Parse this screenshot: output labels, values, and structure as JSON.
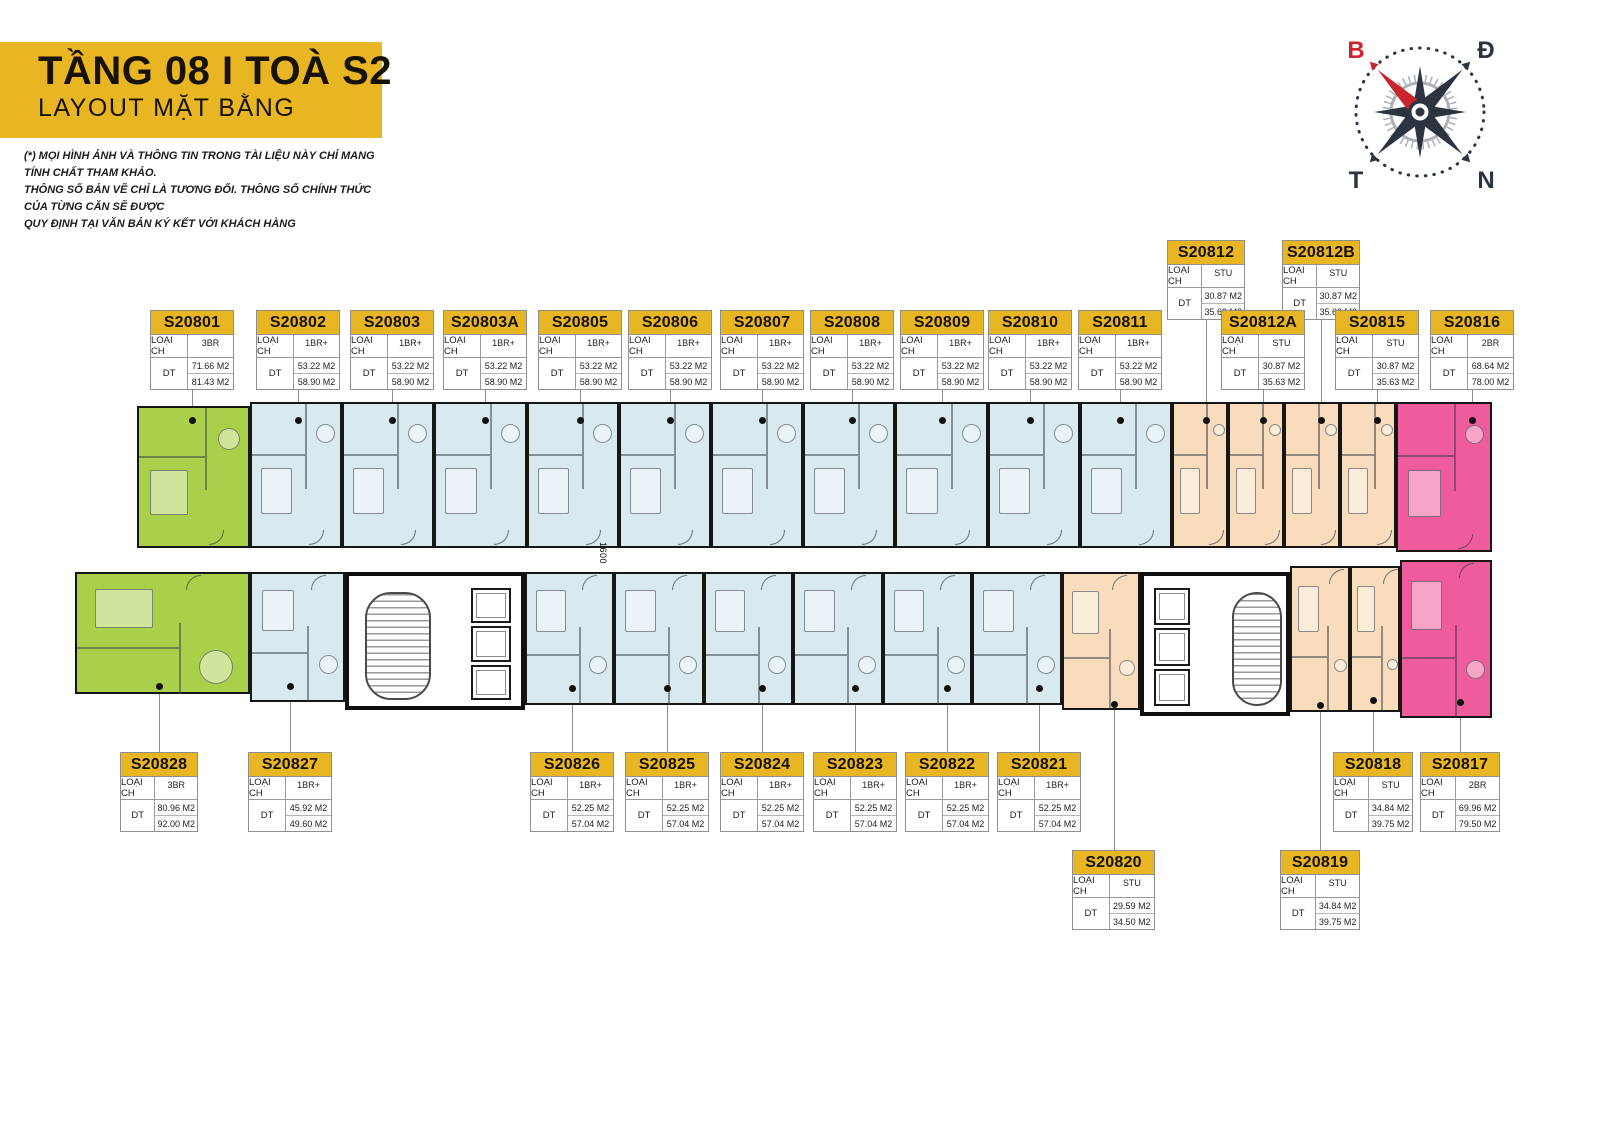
{
  "header": {
    "title": "TẦNG 08 I TOÀ S2",
    "subtitle": "LAYOUT MẶT BẰNG",
    "disclaimer": [
      "(*) MỌI HÌNH ẢNH VÀ THÔNG TIN TRONG TÀI LIỆU NÀY CHỈ MANG TÍNH CHẤT THAM KHẢO.",
      "THÔNG SỐ BẢN VẼ CHỈ LÀ TƯƠNG ĐỐI. THÔNG SỐ CHÍNH THỨC CỦA TỪNG CĂN SẼ ĐƯỢC",
      "QUY ĐỊNH TẠI VĂN BẢN KÝ KẾT VỚI KHÁCH HÀNG"
    ]
  },
  "compass": {
    "north_label": "B",
    "east_label": "Đ",
    "west_label": "T",
    "south_label": "N"
  },
  "plan": {
    "corridor_dimension": "1600"
  },
  "card_labels": {
    "type": "LOẠI CH",
    "area": "DT"
  },
  "colors": {
    "accent_yellow": "#E9B623",
    "type_3BR": "#A9CF4B",
    "type_1BR_plus": "#D9E9F0",
    "type_STU": "#F8DCBC",
    "type_2BR": "#EE5C9C",
    "needle_red": "#C8252C",
    "compass_dark": "#2B3440"
  },
  "units": [
    {
      "id": "S20801",
      "type": "3BR",
      "areas": [
        "71.66 M2",
        "81.43 M2"
      ]
    },
    {
      "id": "S20802",
      "type": "1BR+",
      "areas": [
        "53.22 M2",
        "58.90 M2"
      ]
    },
    {
      "id": "S20803",
      "type": "1BR+",
      "areas": [
        "53.22 M2",
        "58.90 M2"
      ]
    },
    {
      "id": "S20803A",
      "type": "1BR+",
      "areas": [
        "53.22 M2",
        "58.90 M2"
      ]
    },
    {
      "id": "S20805",
      "type": "1BR+",
      "areas": [
        "53.22 M2",
        "58.90 M2"
      ]
    },
    {
      "id": "S20806",
      "type": "1BR+",
      "areas": [
        "53.22 M2",
        "58.90 M2"
      ]
    },
    {
      "id": "S20807",
      "type": "1BR+",
      "areas": [
        "53.22 M2",
        "58.90 M2"
      ]
    },
    {
      "id": "S20808",
      "type": "1BR+",
      "areas": [
        "53.22 M2",
        "58.90 M2"
      ]
    },
    {
      "id": "S20809",
      "type": "1BR+",
      "areas": [
        "53.22 M2",
        "58.90 M2"
      ]
    },
    {
      "id": "S20810",
      "type": "1BR+",
      "areas": [
        "53.22 M2",
        "58.90 M2"
      ]
    },
    {
      "id": "S20811",
      "type": "1BR+",
      "areas": [
        "53.22 M2",
        "58.90 M2"
      ]
    },
    {
      "id": "S20812",
      "type": "STU",
      "areas": [
        "30.87 M2",
        "35.63 M2"
      ]
    },
    {
      "id": "S20812A",
      "type": "STU",
      "areas": [
        "30.87 M2",
        "35.63 M2"
      ]
    },
    {
      "id": "S20812B",
      "type": "STU",
      "areas": [
        "30.87 M2",
        "35.63 M2"
      ]
    },
    {
      "id": "S20815",
      "type": "STU",
      "areas": [
        "30.87 M2",
        "35.63 M2"
      ]
    },
    {
      "id": "S20816",
      "type": "2BR",
      "areas": [
        "68.64 M2",
        "78.00 M2"
      ]
    },
    {
      "id": "S20817",
      "type": "2BR",
      "areas": [
        "69.96 M2",
        "79.50 M2"
      ]
    },
    {
      "id": "S20818",
      "type": "STU",
      "areas": [
        "34.84 M2",
        "39.75 M2"
      ]
    },
    {
      "id": "S20819",
      "type": "STU",
      "areas": [
        "34.84 M2",
        "39.75 M2"
      ]
    },
    {
      "id": "S20820",
      "type": "STU",
      "areas": [
        "29.59 M2",
        "34.50 M2"
      ]
    },
    {
      "id": "S20821",
      "type": "1BR+",
      "areas": [
        "52.25 M2",
        "57.04 M2"
      ]
    },
    {
      "id": "S20822",
      "type": "1BR+",
      "areas": [
        "52.25 M2",
        "57.04 M2"
      ]
    },
    {
      "id": "S20823",
      "type": "1BR+",
      "areas": [
        "52.25 M2",
        "57.04 M2"
      ]
    },
    {
      "id": "S20824",
      "type": "1BR+",
      "areas": [
        "52.25 M2",
        "57.04 M2"
      ]
    },
    {
      "id": "S20825",
      "type": "1BR+",
      "areas": [
        "52.25 M2",
        "57.04 M2"
      ]
    },
    {
      "id": "S20826",
      "type": "1BR+",
      "areas": [
        "52.25 M2",
        "57.04 M2"
      ]
    },
    {
      "id": "S20827",
      "type": "1BR+",
      "areas": [
        "45.92 M2",
        "49.60 M2"
      ]
    },
    {
      "id": "S20828",
      "type": "3BR",
      "areas": [
        "80.96 M2",
        "92.00 M2"
      ]
    }
  ]
}
